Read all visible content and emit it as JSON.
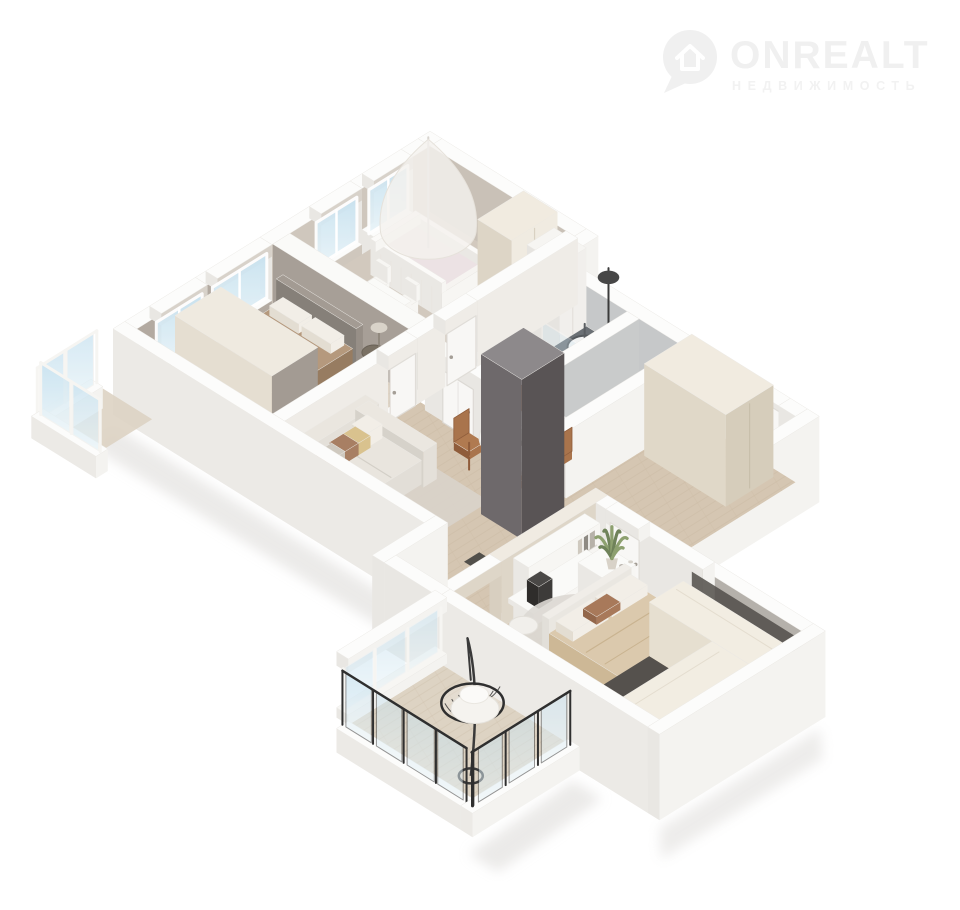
{
  "watermark": {
    "brand": "ONREALT",
    "tagline": "НЕДВИЖИМОСТЬ",
    "icon": "location-pin-house-icon",
    "color": "#f0f0f0",
    "tagline_color": "#f2f2f2"
  },
  "scene": {
    "type": "isometric-3d-floor-plan-render",
    "rooms": [
      {
        "id": "nursery"
      },
      {
        "id": "bathroom"
      },
      {
        "id": "toilet"
      },
      {
        "id": "bedroom-1"
      },
      {
        "id": "living-dining"
      },
      {
        "id": "hallway"
      },
      {
        "id": "bedroom-2"
      },
      {
        "id": "walk-in-closet"
      },
      {
        "id": "balcony"
      },
      {
        "id": "window-bay"
      }
    ]
  },
  "palette": {
    "bg": "#ffffff",
    "wallTop": "#fcfcfb",
    "wallShade": "#e9e7e3",
    "wallLight": "#f4f3f0",
    "nurseryWall": "#cfc7bd",
    "nurseryWallDark": "#c9c1b7",
    "bedroomWall": "#a79f97",
    "bathWall": "#c6c8c9",
    "floorNursery": "#d2c9be",
    "wood": "#d5c6b2",
    "woodBalcony": "#ddd3c3",
    "bathFloor": "#8e979e",
    "bathFloor2": "#9ba3a8",
    "closetFloor": "#55514d",
    "rug": "#d9d3ca",
    "rugRound": "#dcd8d3",
    "cream": "#e9e2d5",
    "creamSide": "#dbd2c1",
    "creamTop": "#f1ebe0",
    "white": "#f7f6f3",
    "whiteSide": "#eae8e4",
    "dark": "#6e696b",
    "darkSide": "#595455",
    "darkTop": "#8d898b",
    "blanket": "#b5997d",
    "blanketSide": "#a3876a",
    "blanket2": "#dbc9ad",
    "blanket2Side": "#cdb896",
    "pillow": "#f2eee7",
    "pillowTan": "#d9c28e",
    "pillowBrown": "#a87f63",
    "caramel": "#b27a4e",
    "chairWood": "#a9744c",
    "chairWoodSide": "#8f5c3a",
    "plant": "#6f8259",
    "plantLight": "#8da06f",
    "glassFrameDark": "#2f2f2f",
    "vanity": "#5d6165",
    "vanityTop": "#6b7075",
    "shadow": "#d8d6d3"
  }
}
